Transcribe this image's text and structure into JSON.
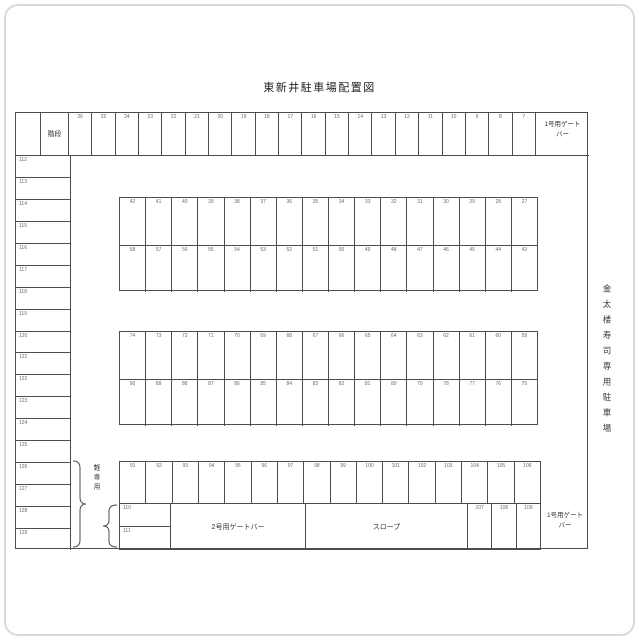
{
  "title": "東新井駐車場配置図",
  "labels": {
    "stairs": "階段",
    "gate1_line1": "1号用ゲート",
    "gate1_line2": "バー",
    "gate2": "2号用ゲートバー",
    "slope": "スロープ",
    "kei_only": "軽専用",
    "side_note": "金太楼寿司専用駐車場"
  },
  "colors": {
    "line": "#4d4d4d",
    "number": "#6a6a6a",
    "text": "#333333",
    "frame": "#d9d9d9"
  },
  "spaces": {
    "top_row": [
      "26",
      "25",
      "24",
      "23",
      "22",
      "21",
      "20",
      "19",
      "18",
      "17",
      "16",
      "15",
      "14",
      "13",
      "12",
      "11",
      "10",
      "9",
      "8",
      "7"
    ],
    "block1_row1": [
      "42",
      "41",
      "40",
      "39",
      "38",
      "37",
      "36",
      "35",
      "34",
      "33",
      "32",
      "31",
      "30",
      "29",
      "28",
      "27"
    ],
    "block1_row2": [
      "58",
      "57",
      "56",
      "55",
      "54",
      "53",
      "52",
      "51",
      "50",
      "49",
      "48",
      "47",
      "46",
      "45",
      "44",
      "43"
    ],
    "block2_row1": [
      "74",
      "73",
      "72",
      "71",
      "70",
      "69",
      "68",
      "67",
      "66",
      "65",
      "64",
      "63",
      "62",
      "61",
      "60",
      "59"
    ],
    "block2_row2": [
      "90",
      "89",
      "88",
      "87",
      "86",
      "85",
      "84",
      "83",
      "82",
      "81",
      "80",
      "79",
      "78",
      "77",
      "76",
      "75"
    ],
    "bottom_row": [
      "91",
      "92",
      "93",
      "94",
      "95",
      "96",
      "97",
      "98",
      "99",
      "100",
      "101",
      "102",
      "103",
      "104",
      "105",
      "106"
    ],
    "gate_side_cells": [
      "107",
      "108",
      "109"
    ],
    "small_column": [
      "110",
      "111"
    ],
    "left_column": [
      "112",
      "113",
      "114",
      "115",
      "116",
      "117",
      "118",
      "119",
      "120",
      "121",
      "122",
      "123",
      "124",
      "125",
      "126",
      "127",
      "128",
      "129"
    ]
  }
}
